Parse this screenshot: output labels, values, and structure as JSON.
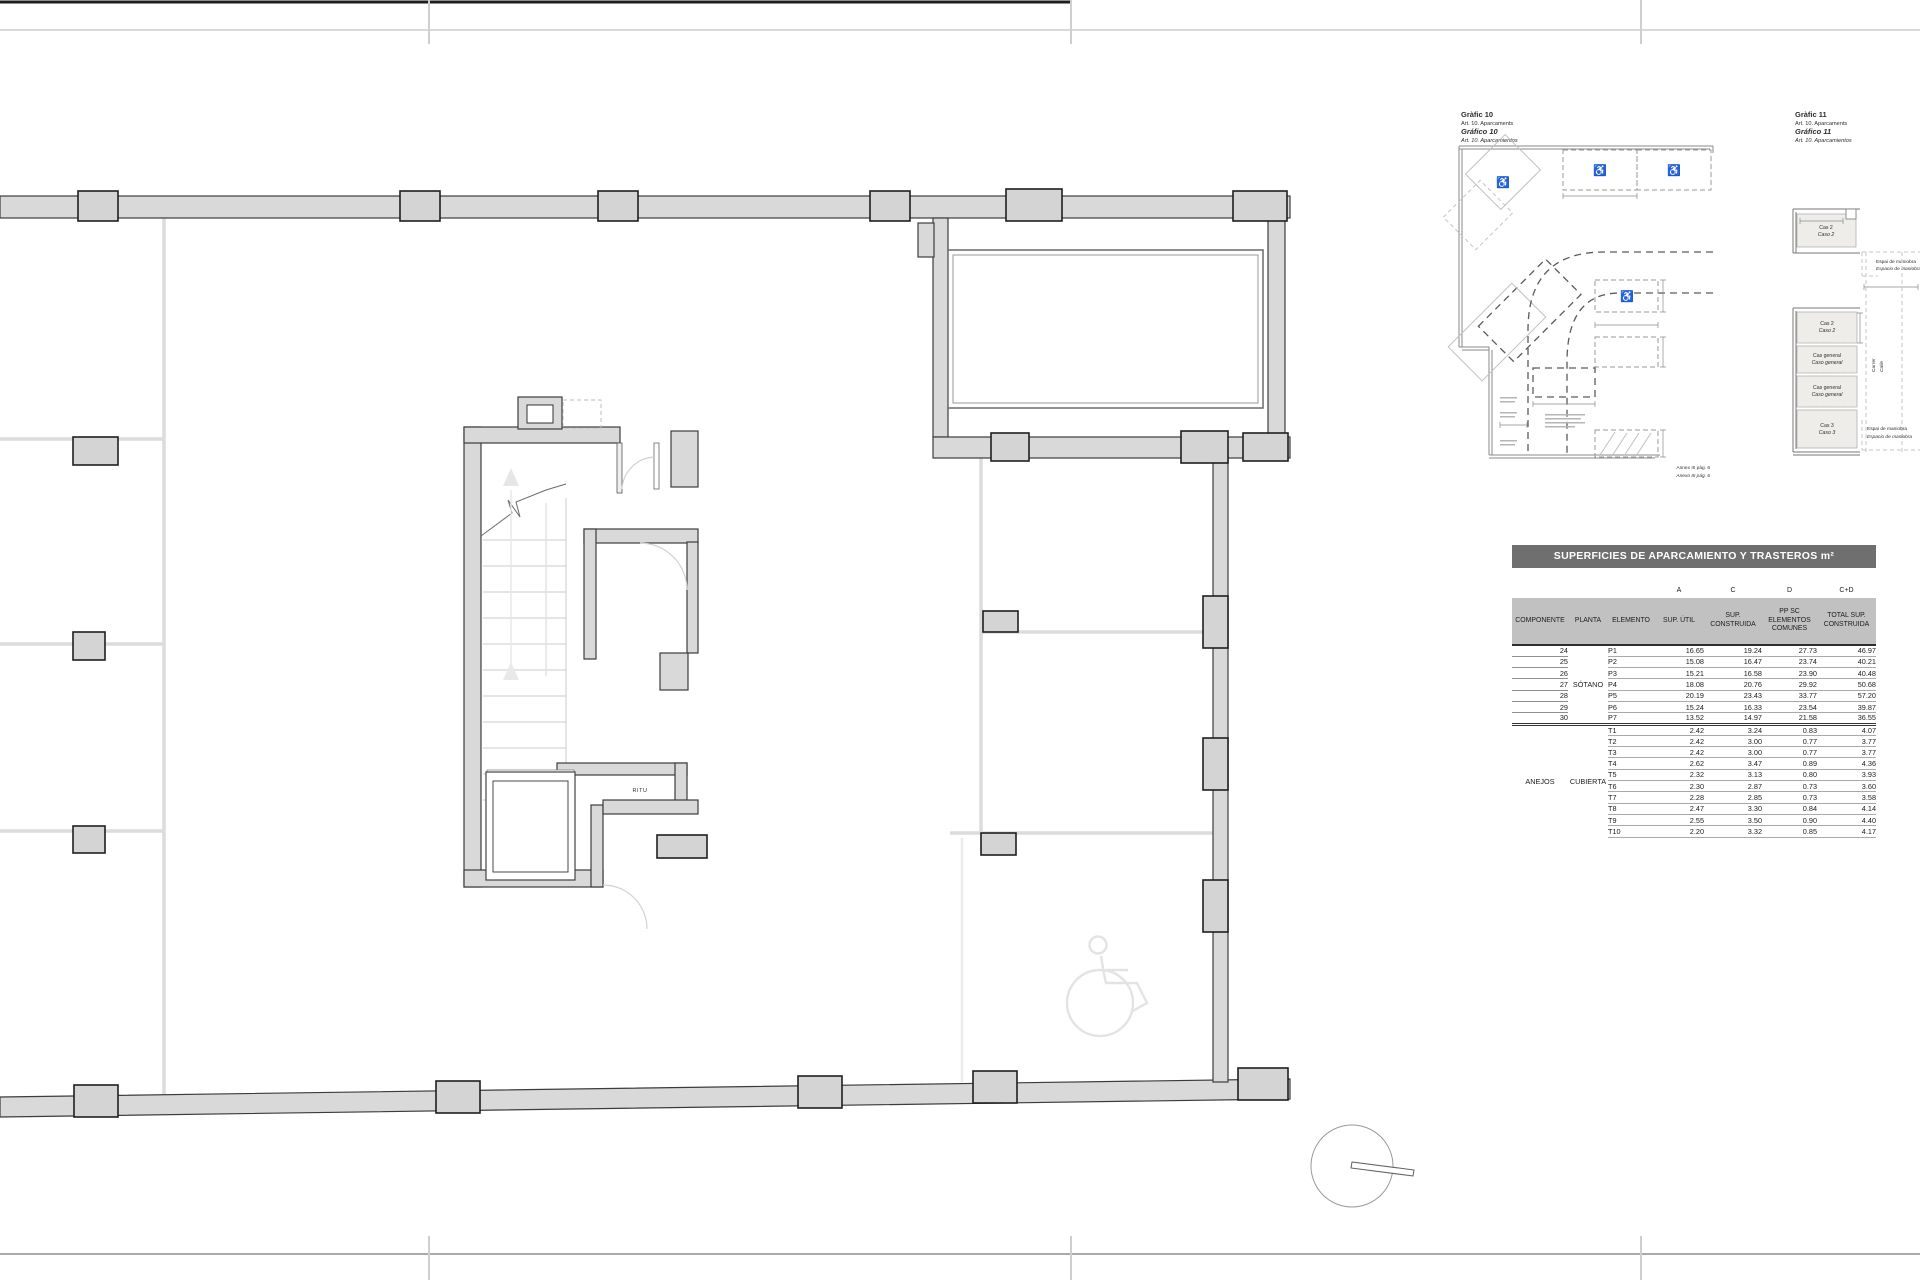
{
  "grafico10": {
    "title_ca": "Gràfic 10",
    "article_ca": "Art. 10. Aparcaments",
    "title_es": "Gráfico 10",
    "article_es": "Art. 10. Aparcamientos",
    "annex_ref_ca": "Annex III pàg. 6",
    "annex_ref_es": "Anexo III pág. 6",
    "wheelchair_icon": "♿"
  },
  "grafico11": {
    "title_ca": "Gràfic 11",
    "article_ca": "Art. 10. Aparcaments",
    "title_es": "Gráfico 11",
    "article_es": "Art. 10. Aparcamientos",
    "case2_ca": "Cas 2",
    "case2_es": "Caso 2",
    "case_general_ca": "Cas general",
    "case_general_es": "Caso general",
    "case3_ca": "Cas 3",
    "case3_es": "Caso 3",
    "maneuver_ca": "Espai de maniobra",
    "maneuver_es": "Espacio de maniobra",
    "street_ca": "Carrer",
    "street_es": "Calle"
  },
  "plan": {
    "room_label": "RITU"
  },
  "table": {
    "title": "SUPERFICIES DE APARCAMIENTO Y TRASTEROS m²",
    "letters": {
      "a": "A",
      "c": "C",
      "d": "D",
      "cd": "C+D"
    },
    "headers": [
      "COMPONENTE",
      "PLANTA",
      "ELEMENTO",
      "SUP. ÚTIL",
      "SUP. CONSTRUIDA",
      "PP SC ELEMENTOS COMUNES",
      "TOTAL SUP. CONSTRUIDA"
    ],
    "sections": [
      {
        "componente_label": "",
        "planta_label": "SÓTANO",
        "rows": [
          [
            "24",
            "P1",
            "16.65",
            "19.24",
            "27.73",
            "46.97"
          ],
          [
            "25",
            "P2",
            "15.08",
            "16.47",
            "23.74",
            "40.21"
          ],
          [
            "26",
            "P3",
            "15.21",
            "16.58",
            "23.90",
            "40.48"
          ],
          [
            "27",
            "P4",
            "18.08",
            "20.76",
            "29.92",
            "50.68"
          ],
          [
            "28",
            "P5",
            "20.19",
            "23.43",
            "33.77",
            "57.20"
          ],
          [
            "29",
            "P6",
            "15.24",
            "16.33",
            "23.54",
            "39.87"
          ],
          [
            "30",
            "P7",
            "13.52",
            "14.97",
            "21.58",
            "36.55"
          ]
        ]
      },
      {
        "componente_label": "ANEJOS",
        "planta_label": "CUBIERTA",
        "rows": [
          [
            "",
            "T1",
            "2.42",
            "3.24",
            "0.83",
            "4.07"
          ],
          [
            "",
            "T2",
            "2.42",
            "3.00",
            "0.77",
            "3.77"
          ],
          [
            "",
            "T3",
            "2.42",
            "3.00",
            "0.77",
            "3.77"
          ],
          [
            "",
            "T4",
            "2.62",
            "3.47",
            "0.89",
            "4.36"
          ],
          [
            "",
            "T5",
            "2.32",
            "3.13",
            "0.80",
            "3.93"
          ],
          [
            "",
            "T6",
            "2.30",
            "2.87",
            "0.73",
            "3.60"
          ],
          [
            "",
            "T7",
            "2.28",
            "2.85",
            "0.73",
            "3.58"
          ],
          [
            "",
            "T8",
            "2.47",
            "3.30",
            "0.84",
            "4.14"
          ],
          [
            "",
            "T9",
            "2.55",
            "3.50",
            "0.90",
            "4.40"
          ],
          [
            "",
            "T10",
            "2.20",
            "3.32",
            "0.85",
            "4.17"
          ]
        ]
      }
    ]
  }
}
